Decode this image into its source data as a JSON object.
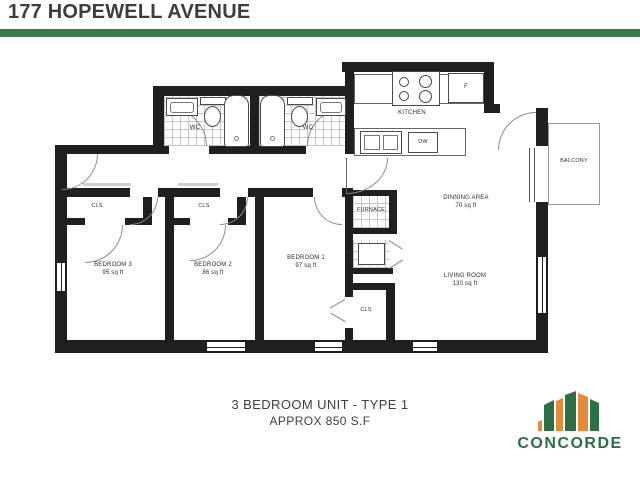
{
  "header": {
    "title": "177 HOPEWELL AVENUE"
  },
  "floorplan": {
    "wc_left": {
      "label": "WC"
    },
    "wc_right": {
      "label": "WC"
    },
    "kitchen": {
      "label": "KITCHEN",
      "fridge": "F",
      "dishwasher": "DW"
    },
    "balcony": {
      "label": "BALCONY"
    },
    "furnace": {
      "label": "FURNACE"
    },
    "washer_dryer": {
      "label": "W/D"
    },
    "dining": {
      "label": "DINNING AREA",
      "area": "70 sq ft"
    },
    "living": {
      "label": "LIVING ROOM",
      "area": "130 sq ft"
    },
    "bedroom1": {
      "label": "BEDROOM 1",
      "area": "97 sq ft"
    },
    "bedroom2": {
      "label": "BEDROOM 2",
      "area": "86 sq ft"
    },
    "bedroom3": {
      "label": "BEDROOM 3",
      "area": "95 sq ft"
    },
    "closet_bedroom1": {
      "label": "CLS"
    },
    "closet_bedroom2": {
      "label": "CLS"
    },
    "closet_bedroom3": {
      "label": "CLS"
    }
  },
  "footer": {
    "line1": "3 BEDROOM UNIT - TYPE 1",
    "line2": "APPROX 850 S.F"
  },
  "logo": {
    "text": "CONCORDE"
  },
  "colors": {
    "accent_green": "#3a7a4a",
    "logo_green": "#2d7046",
    "logo_orange": "#e5893a",
    "wall_black": "#1f1f1f",
    "title_gray": "#3d3d3d"
  }
}
